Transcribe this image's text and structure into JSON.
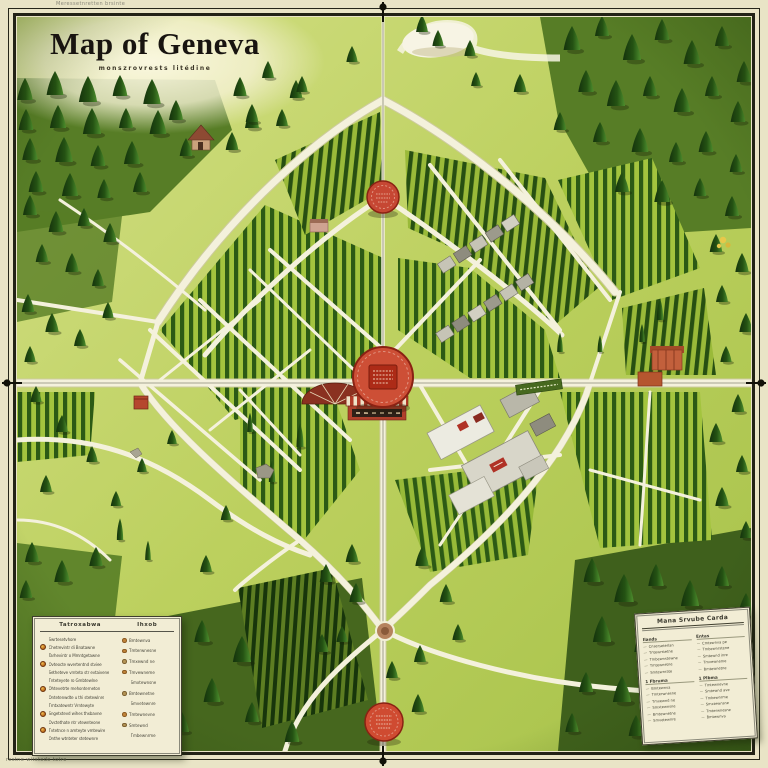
{
  "title": {
    "text": "Map of Geneva",
    "subtitle": "monszrovrests litédine"
  },
  "margin_notes": {
    "top": "Meressetnretten brsinte",
    "bottom": "restne witstede totre"
  },
  "colors": {
    "accent_red": "#c94a32",
    "field_dark_green": "#2d5a16",
    "field_light_green": "#a3c43e",
    "road_cream": "#f4f1dc",
    "paper": "#e9e4c6"
  },
  "legend_left": {
    "header_left": "Tatroxabwa",
    "header_right": "Ihxob",
    "left_rows": [
      {
        "marker": "",
        "text": "Swrtesetvhore"
      },
      {
        "marker": "badge",
        "text": "Chetrevintr di Bnatawne"
      },
      {
        "marker": "",
        "text": "Tarhevintr o Mmntgetawne"
      },
      {
        "marker": "badge",
        "text": "Ovteocte wvertentnd stviee"
      },
      {
        "marker": "",
        "text": "Setheteve vrnteto str evtaivene"
      },
      {
        "marker": "",
        "text": "Tnteteyete ro Gmbtewlne"
      },
      {
        "marker": "badge",
        "text": "Ohtevetrte mehonterneton"
      },
      {
        "marker": "",
        "text": "Ontetenwdte u thi stetewlnre"
      },
      {
        "marker": "",
        "text": "Tmtxatewntr Vrntewyte"
      },
      {
        "marker": "badge",
        "text": "Sngetxtevd wihes thxbavne"
      },
      {
        "marker": "",
        "text": "Ovctethate ntr vtewnteone"
      },
      {
        "marker": "badge",
        "text": "Tvtetnce n amteyte vmtewire"
      },
      {
        "marker": "",
        "text": "Onthe wtnteter stetewnre"
      }
    ],
    "right_rows": [
      {
        "marker": "dot",
        "text": "Bmtewnva"
      },
      {
        "marker": "dot",
        "text": "Tmterwnesne"
      },
      {
        "marker": "dot2",
        "text": "Tmxewnd ne"
      },
      {
        "marker": "dot",
        "text": "Tmvewneme"
      },
      {
        "marker": "",
        "text": "Smxtewnsne"
      },
      {
        "marker": "dot2",
        "text": "Bmtewnetne"
      },
      {
        "marker": "",
        "text": "Smvetewnre"
      },
      {
        "marker": "dot",
        "text": "Tmtewnevne"
      },
      {
        "marker": "dot2",
        "text": "Smtewnd"
      },
      {
        "marker": "",
        "text": "Tmbewnrme"
      }
    ]
  },
  "legend_right": {
    "title": "Mana Srvube Carda",
    "col1": [
      {
        "header": "Ilands",
        "rows": [
          "Cnserseterlan",
          "Tntewrstetne",
          "Tmbewnstewne",
          "Tmtewnetne",
          "Smtewnrate"
        ]
      },
      {
        "header": "1 Fbruma",
        "rows": [
          "Bmtewnva",
          "Tmterwnesne",
          "Tmxewnd ne",
          "Smxtewnsne",
          "Bmtewnetne",
          "Smvetewnre"
        ]
      }
    ],
    "col2": [
      {
        "header": "Entas",
        "rows": [
          "Cmtewnva pe",
          "Tmbewnrstene",
          "Smtewnd inre",
          "Tmvewneme",
          "Bmtewnetne"
        ]
      },
      {
        "header": "1 Plbma",
        "rows": [
          "Tmtewnevne",
          "Smtewnd ave",
          "Tmbewnrme",
          "Smxtewnsne",
          "Tmterwnesne",
          "Bmtewnva"
        ]
      }
    ]
  }
}
